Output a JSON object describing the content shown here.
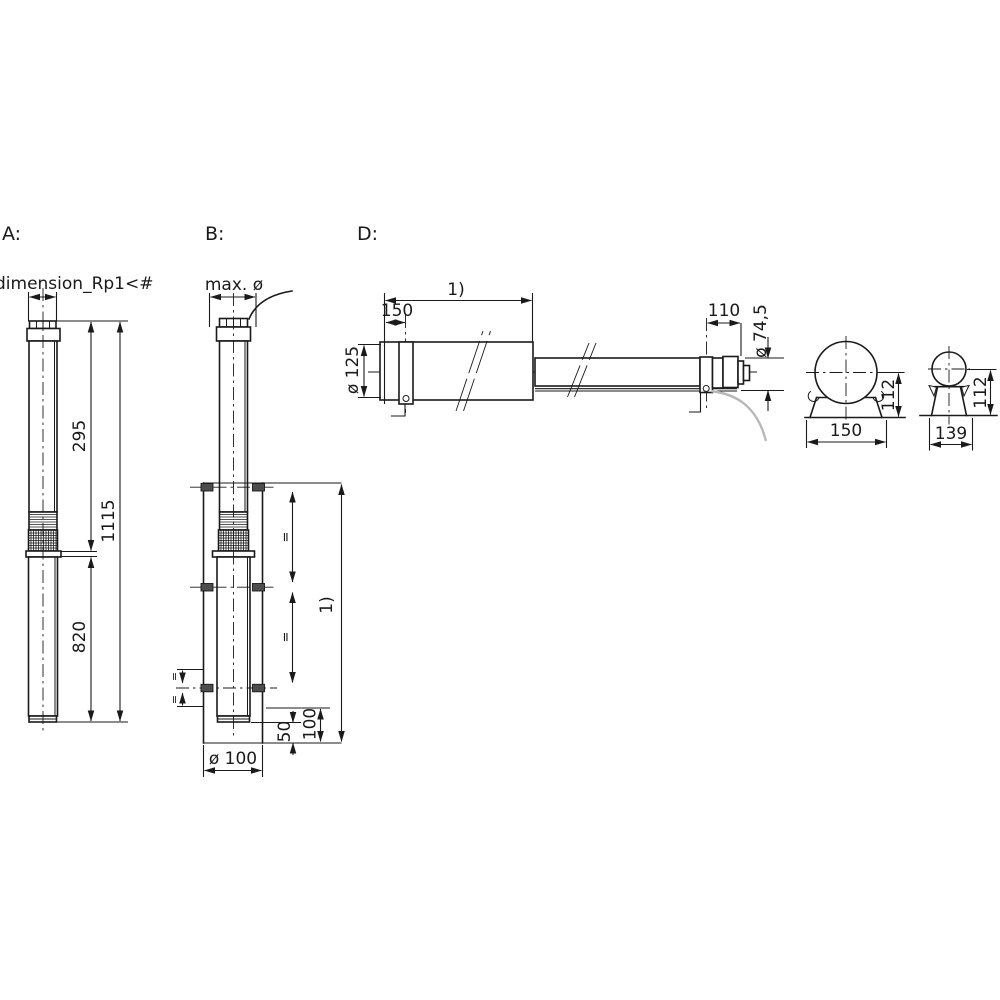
{
  "views": {
    "a": {
      "label": "A:",
      "dims": {
        "connection_thread": "dimension_Rp1<#",
        "pump_section_length": "295",
        "motor_section_length": "820",
        "total_length": "1115"
      }
    },
    "b": {
      "label": "B:",
      "dims": {
        "max_diameter": "max. ø",
        "well_length_ref": "1)",
        "equal_spacing_mark": "=",
        "clearance_bottom": "100",
        "clearance_tip": "50",
        "well_diameter": "ø 100"
      }
    },
    "d": {
      "label": "D:",
      "dims": {
        "length_ref": "1)",
        "clamp_offset_left": "150",
        "clamp_offset_right": "110",
        "pump_diameter": "ø 125",
        "motor_diameter": "ø 74,5"
      }
    },
    "end_view_large": {
      "dims": {
        "bracket_width": "150",
        "axis_height": "112"
      }
    },
    "end_view_small": {
      "dims": {
        "bracket_width": "139",
        "axis_height": "112"
      }
    }
  }
}
